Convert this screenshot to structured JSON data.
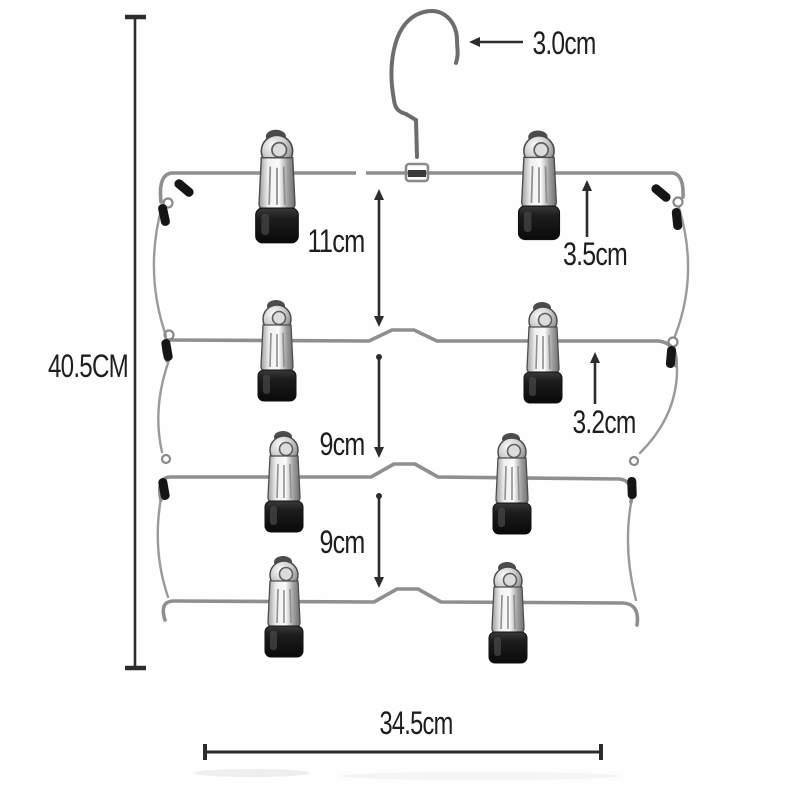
{
  "figure": {
    "type": "product dimension diagram",
    "tiers": 4,
    "clips_per_tier": 2
  },
  "annotations": {
    "hook_width": "3.0cm",
    "total_height": "40.5CM",
    "first_tier_gap": "11cm",
    "clip_length_top": "3.5cm",
    "clip_length_lower": "3.2cm",
    "second_tier_gap": "9cm",
    "third_tier_gap": "9cm",
    "bar_width": "34.5cm"
  },
  "colors": {
    "background": "#fefefe",
    "wire": "#8f8f8f",
    "clip_rubber_tip": "#151515",
    "dimension_ink": "#2c2c2c",
    "label_ink": "#1e1e1e"
  }
}
